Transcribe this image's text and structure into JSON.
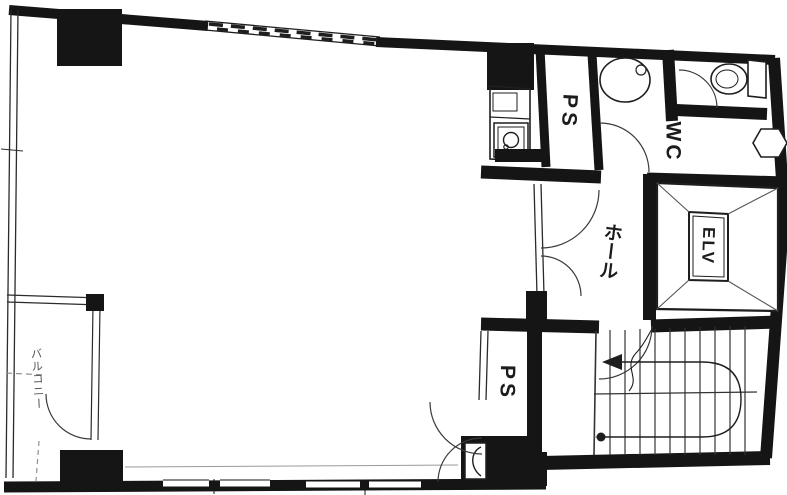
{
  "plan": {
    "title": "building-floor-plan",
    "labels": {
      "balcony": "バルコニー",
      "hall": "ホール",
      "elevator": "ELV",
      "toilet_room": "WC",
      "pipe_space_top": "PS",
      "pipe_space_bottom": "PS"
    },
    "colors": {
      "wall": "#151515",
      "background": "#ffffff",
      "thin_line": "#2b2b2b",
      "faint_line": "#8f8f8f"
    }
  }
}
